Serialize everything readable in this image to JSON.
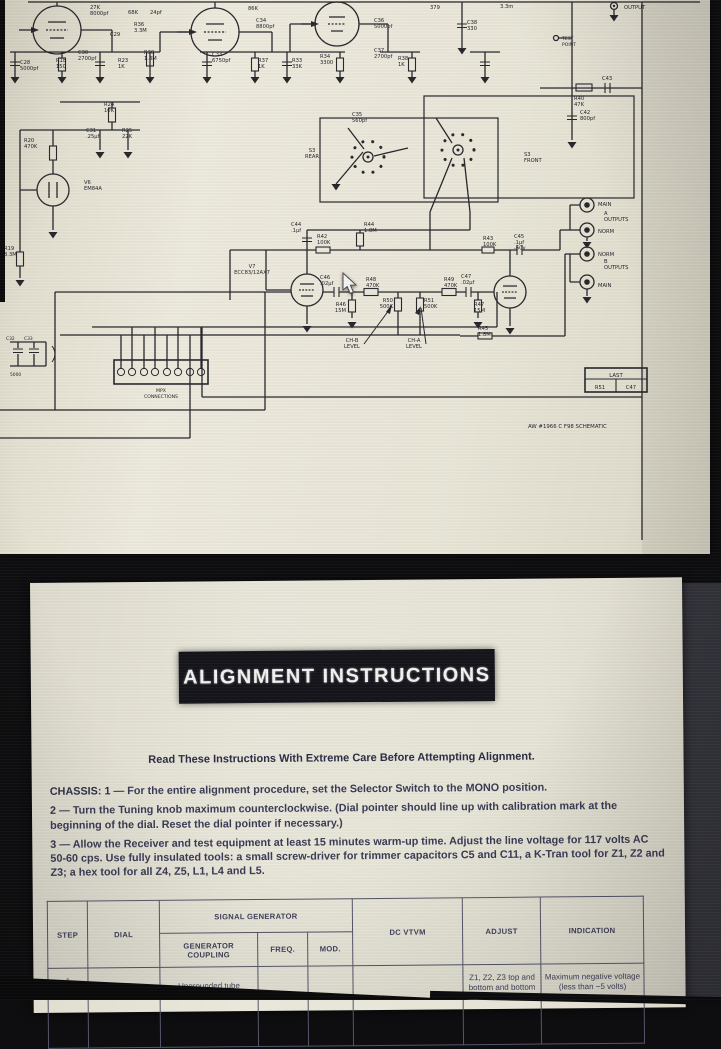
{
  "schematic_page": {
    "footer": "AW #1966 C F98 SCHEMATIC",
    "labels": [
      {
        "t": "27K\n8000pf",
        "x": 90,
        "y": 9
      },
      {
        "t": "C29",
        "x": 110,
        "y": 36
      },
      {
        "t": "68K",
        "x": 128,
        "y": 14
      },
      {
        "t": "24pf",
        "x": 150,
        "y": 14
      },
      {
        "t": "R36\n3.3M",
        "x": 134,
        "y": 26
      },
      {
        "t": "86K",
        "x": 248,
        "y": 10
      },
      {
        "t": "C34\n8800pf",
        "x": 256,
        "y": 22
      },
      {
        "t": "C28\n5000pf",
        "x": 20,
        "y": 64
      },
      {
        "t": "R18\n150",
        "x": 56,
        "y": 62
      },
      {
        "t": "C30\n2700pf",
        "x": 78,
        "y": 54
      },
      {
        "t": "R23\n1K",
        "x": 118,
        "y": 62
      },
      {
        "t": "R30\n1.8M",
        "x": 144,
        "y": 54
      },
      {
        "t": "C33\n6750pf",
        "x": 212,
        "y": 56
      },
      {
        "t": "R37\n1K",
        "x": 258,
        "y": 62
      },
      {
        "t": "R33\n33K",
        "x": 292,
        "y": 62
      },
      {
        "t": "R34\n3300",
        "x": 320,
        "y": 58
      },
      {
        "t": "C36\n5000pf",
        "x": 374,
        "y": 22
      },
      {
        "t": "C37\n2700pf",
        "x": 374,
        "y": 52
      },
      {
        "t": "R38\n1K",
        "x": 398,
        "y": 60
      },
      {
        "t": "379",
        "x": 430,
        "y": 9
      },
      {
        "t": "C38\n330",
        "x": 467,
        "y": 24
      },
      {
        "t": "3.3m",
        "x": 500,
        "y": 8
      },
      {
        "t": "OUTPUT",
        "x": 624,
        "y": 9
      },
      {
        "t": "TEST\nPOINT",
        "x": 562,
        "y": 40,
        "s": 4.6
      },
      {
        "t": "R40\n47K",
        "x": 574,
        "y": 100
      },
      {
        "t": "C43",
        "x": 602,
        "y": 80
      },
      {
        "t": "C42\n800pf",
        "x": 580,
        "y": 114
      },
      {
        "t": "R24\n10K",
        "x": 104,
        "y": 106
      },
      {
        "t": "C31\n.25µf",
        "x": 86,
        "y": 132
      },
      {
        "t": "R25\n22K",
        "x": 122,
        "y": 132
      },
      {
        "t": "R20\n470K",
        "x": 24,
        "y": 142
      },
      {
        "t": "V6\nEM84A",
        "x": 84,
        "y": 184
      },
      {
        "t": "R19\n3.3M",
        "x": 4,
        "y": 250
      },
      {
        "t": "C35\n560pf",
        "x": 352,
        "y": 116
      },
      {
        "t": "S3\nREAR",
        "x": 312,
        "y": 152,
        "a": "middle"
      },
      {
        "t": "S3\nFRONT",
        "x": 524,
        "y": 156
      },
      {
        "t": "V7\nECC83/12AX7",
        "x": 252,
        "y": 268,
        "a": "middle"
      },
      {
        "t": "C44\n.1µf",
        "x": 291,
        "y": 226
      },
      {
        "t": "R42\n100K",
        "x": 317,
        "y": 238
      },
      {
        "t": "R44\n1.8M",
        "x": 364,
        "y": 226
      },
      {
        "t": "R48\n470K",
        "x": 366,
        "y": 281
      },
      {
        "t": "C46\n.02µf",
        "x": 320,
        "y": 279
      },
      {
        "t": "R46\n15M",
        "x": 346,
        "y": 306,
        "a": "end"
      },
      {
        "t": "R50\n500K",
        "x": 393,
        "y": 302,
        "a": "end"
      },
      {
        "t": "R51\n500K",
        "x": 424,
        "y": 302
      },
      {
        "t": "R49\n470K",
        "x": 444,
        "y": 281
      },
      {
        "t": "C47\n.02µf",
        "x": 461,
        "y": 278
      },
      {
        "t": "R47\n15M",
        "x": 474,
        "y": 306
      },
      {
        "t": "R43\n100K",
        "x": 483,
        "y": 240
      },
      {
        "t": "C45\n.1µf\n-60v",
        "x": 514,
        "y": 238
      },
      {
        "t": "R45\n1.8M",
        "x": 478,
        "y": 330
      },
      {
        "t": "CH-B\nLEVEL",
        "x": 352,
        "y": 342,
        "a": "middle"
      },
      {
        "t": "CH-A\nLEVEL",
        "x": 414,
        "y": 342,
        "a": "middle"
      },
      {
        "t": "MPX\nCONNECTIONS",
        "x": 161,
        "y": 392,
        "s": 4.6,
        "a": "middle"
      },
      {
        "t": "MAIN",
        "x": 598,
        "y": 206
      },
      {
        "t": "A\nOUTPUTS",
        "x": 604,
        "y": 215
      },
      {
        "t": "NORM",
        "x": 598,
        "y": 233
      },
      {
        "t": "NORM",
        "x": 598,
        "y": 256
      },
      {
        "t": "B\nOUTPUTS",
        "x": 604,
        "y": 263
      },
      {
        "t": "MAIN",
        "x": 598,
        "y": 287
      },
      {
        "t": "LAST",
        "x": 616,
        "y": 377,
        "a": "middle",
        "s": 5.4
      },
      {
        "t": "R51",
        "x": 600,
        "y": 389,
        "a": "middle"
      },
      {
        "t": "C47",
        "x": 631,
        "y": 389,
        "a": "middle"
      },
      {
        "t": "C32",
        "x": 6,
        "y": 340,
        "s": 4.4
      },
      {
        "t": "C33",
        "x": 24,
        "y": 340,
        "s": 4.4
      },
      {
        "t": "5000",
        "x": 10,
        "y": 376,
        "s": 4.4
      },
      {
        "t": "AW #1966 C F98 SCHEMATIC",
        "x": 528,
        "y": 428,
        "s": 5.4
      }
    ]
  },
  "instructions_page": {
    "title": "ALIGNMENT INSTRUCTIONS",
    "subtitle": "Read These Instructions With Extreme Care Before Attempting Alignment.",
    "paragraphs": [
      {
        "lead": "CHASSIS: 1 —",
        "text": "For the entire alignment procedure, set the Selector Switch to the MONO position."
      },
      {
        "lead": "2 —",
        "text": "Turn the Tuning knob maximum counterclockwise.  (Dial pointer should line up with calibration mark at the beginning of the dial.  Reset the dial pointer if necessary.)"
      },
      {
        "lead": "3 —",
        "text": "Allow the Receiver and test equipment at least 15 minutes warm-up time.  Adjust the line voltage for 117 volts AC 50-60 cps.  Use fully insulated tools: a small screw-driver for trimmer capacitors C5 and C11, a K-Tran tool for Z1, Z2 and Z3; a hex tool for all Z4, Z5, L1, L4 and L5."
      }
    ],
    "table": {
      "headers": {
        "step": "STEP",
        "dial": "DIAL",
        "signal_generator": "SIGNAL GENERATOR",
        "dc_vtvm": "DC VTVM",
        "adjust": "ADJUST",
        "indication": "INDICATION",
        "generator_coupling": "GENERATOR COUPLING",
        "freq": "FREQ.",
        "mod": "MOD."
      },
      "row1": {
        "step": "1",
        "dial": "",
        "generator_coupling": "Ungrounded tube",
        "freq": "",
        "mod": "",
        "dc_vtvm": "",
        "adjust": "Z1, Z2, Z3 top and bottom and bottom Z4",
        "indication": "Maximum negative voltage (less than −5 volts)"
      }
    }
  }
}
